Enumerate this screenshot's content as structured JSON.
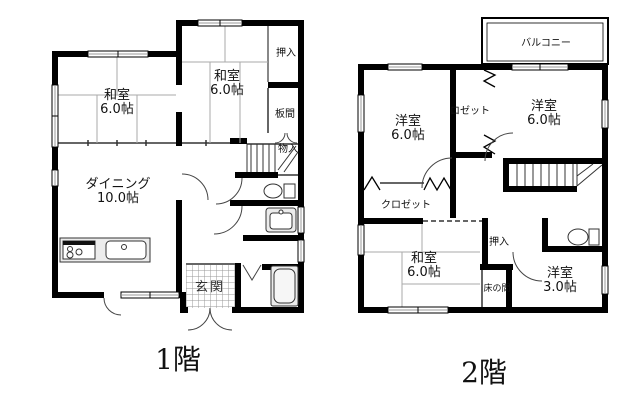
{
  "colors": {
    "wall": "#000000",
    "thin_line": "#333333",
    "window_line": "#999999",
    "tatami_line": "#aaaaaa",
    "fixture_fill": "#ececec",
    "hatch": "#999999"
  },
  "floor1": {
    "title": "1階",
    "rooms": {
      "washitsu_left": {
        "name": "和室",
        "size": "6.0帖"
      },
      "washitsu_top": {
        "name": "和室",
        "size": "6.0帖"
      },
      "oshiire": "押入",
      "itanoma": "板間",
      "monoire": "物入",
      "dining": {
        "name": "ダイニング",
        "size": "10.0帖"
      },
      "genkan": "玄関"
    }
  },
  "floor2": {
    "title": "2階",
    "rooms": {
      "balcony": "バルコニー",
      "yoshitsu_left": {
        "name": "洋室",
        "size": "6.0帖"
      },
      "closet_mid": "ロゼット",
      "yoshitsu_right": {
        "name": "洋室",
        "size": "6.0帖"
      },
      "closet_left": "クロゼット",
      "washitsu": {
        "name": "和室",
        "size": "6.0帖"
      },
      "oshiire": "押入",
      "tokonoma": "床の間",
      "yoshitsu_small": {
        "name": "洋室",
        "size": "3.0帖"
      }
    }
  }
}
